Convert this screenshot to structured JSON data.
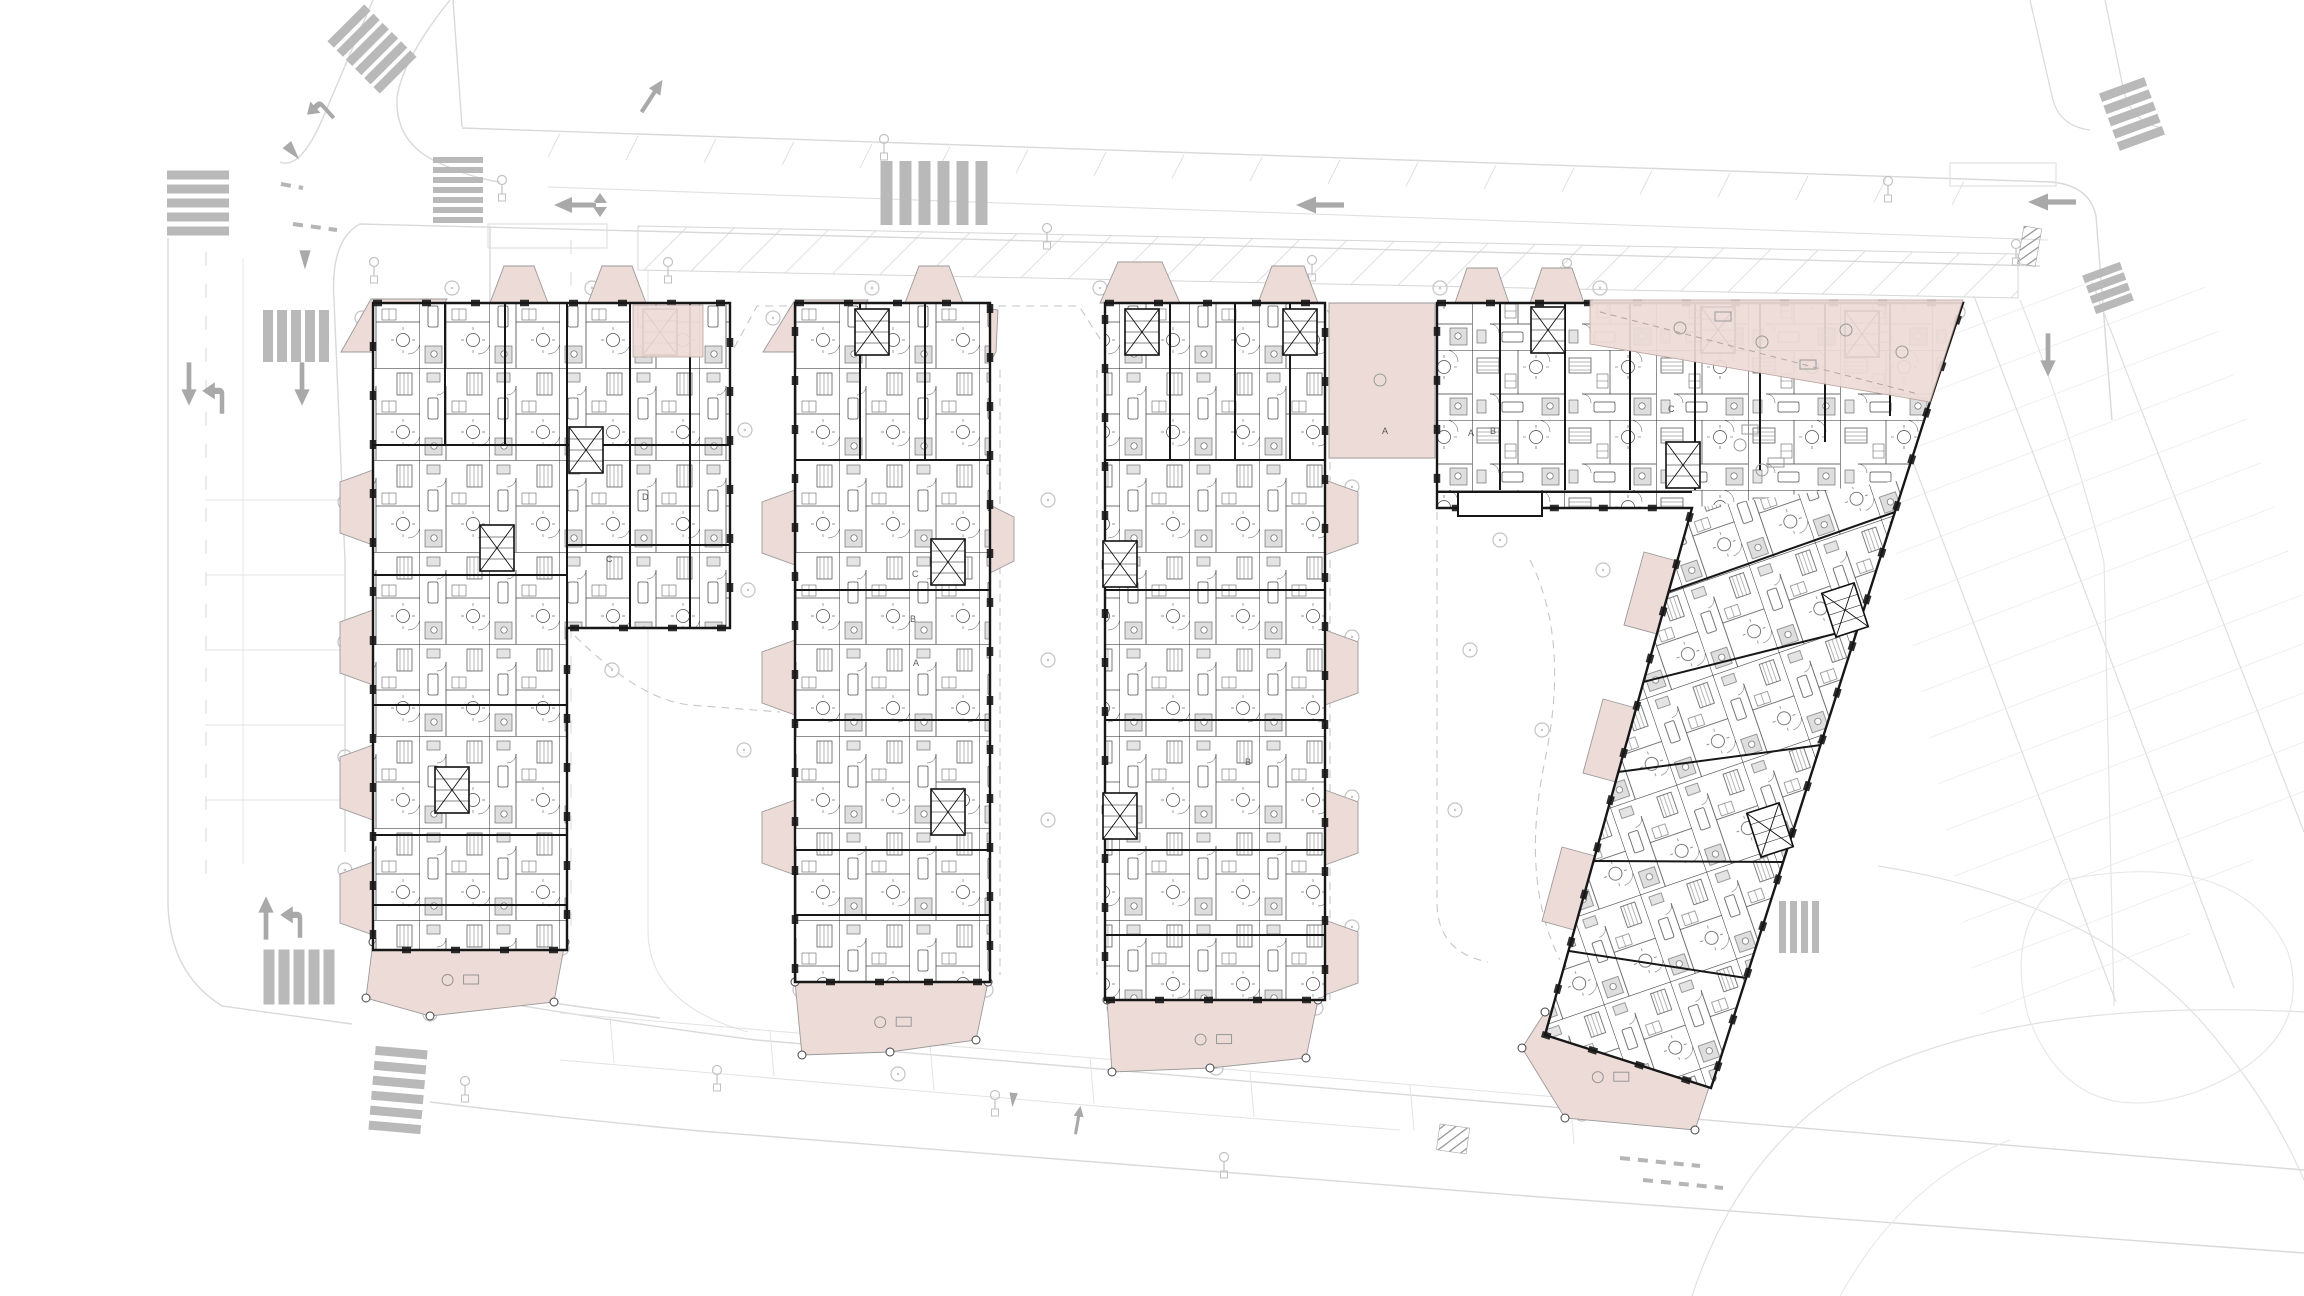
{
  "meta": {
    "drawing_type": "architectural residential site plan / floor plan",
    "floor": "typical floor with ground-level roads",
    "visible_text_labels": [
      "A",
      "B",
      "C",
      "D"
    ]
  },
  "palette": {
    "terrace_pink": "#eddbd7",
    "terrace_edge": "#9a9a9a",
    "wall_black": "#171717",
    "room_line": "#3d3d3d",
    "road_line": "#d9d9d9",
    "road_line_faint": "#e4e4e4",
    "marking_gray": "#a9a9a9",
    "crosswalk_gray": "#b9b9b9",
    "hatch_gray": "#cfcfcf",
    "hatch_dark": "#8f8f8f",
    "dash_gray": "#c6c6c6",
    "tree_gray": "#c4c4c4",
    "bath_gray": "#dcdcdc"
  },
  "site": {
    "paths": [
      {
        "d": "M 462,128 L 2052,182 Q 2090,186 2096,216 L 2112,420"
      },
      {
        "d": "M 453,0 L 462,127"
      },
      {
        "d": "M 373,0 L 322,120 Q 300,170 280,162"
      },
      {
        "d": "M 450,0 Q 402,60 397,98 Q 395,140 433,160 Q 470,178 500,182"
      },
      {
        "d": "M 2040,266 L 360,224 Q 330,240 334,300 L 345,560 L 345,852"
      },
      {
        "d": "M 548,187 L 2048,240",
        "c": "#e0e0e0",
        "w": 1.1
      },
      {
        "d": "M 168,238 L 168,900 Q 168,972 222,1006 L 352,1024"
      },
      {
        "d": "M 243,258 L 243,864",
        "c": "#e7e7e7",
        "w": 1
      },
      {
        "d": "M 206,252 L 206,880",
        "c": "#dedede",
        "w": 1.2,
        "dash": "14 18"
      },
      {
        "d": "M 490,226 L 490,930 Q 490,988 560,1004 L 660,1018"
      },
      {
        "d": "M 648,270 L 648,930 Q 648,1004 748,1032",
        "c": "#e4e4e4",
        "w": 1.1
      },
      {
        "d": "M 571,240 L 571,930",
        "c": "#dedede",
        "w": 1.2,
        "dash": "14 18"
      },
      {
        "d": "M 428,990 Q 600,1020 756,1040 L 1540,1106 Q 1820,1128 2304,1170"
      },
      {
        "d": "M 430,1102 Q 560,1118 700,1131 L 1540,1197 Q 1900,1225 2304,1253"
      },
      {
        "d": "M 560,1013 L 1117,1060 L 1640,1104",
        "c": "#e2e2e2",
        "w": 1
      },
      {
        "d": "M 560,1060 L 1120,1108 L 1400,1130",
        "c": "#e2e2e2",
        "w": 1
      },
      {
        "d": "M 2030,0 L 2052,96 Q 2058,126 2090,130",
        "w": 1.2
      },
      {
        "d": "M 2105,0 L 2124,92 Q 2132,122 2162,128",
        "w": 1.2
      },
      {
        "d": "M 2020,300 Q 2068,420 2104,562 L 2114,1006",
        "c": "#e2e2e2",
        "w": 1.1
      },
      {
        "d": "M 1878,866 Q 2090,900 2200,1020 Q 2270,1100 2304,1180",
        "c": "#e0e0e0",
        "w": 1.2
      },
      {
        "d": "M 1692,1296 Q 1745,1135 1880,1068 Q 2040,998 2304,1012",
        "c": "#e0e0e0",
        "w": 1.2
      },
      {
        "d": "M 2064,880 Q 2240,846 2288,952 Q 2316,1046 2196,1092 Q 2072,1134 2028,1016 Q 2004,922 2064,880 Z",
        "c": "#e6e6e6",
        "w": 1.1
      },
      {
        "d": "M 1840,1296 Q 1905,1180 2010,1140",
        "c": "#e6e6e6",
        "w": 1
      }
    ],
    "rects": [
      [
        488,
        224,
        119,
        24
      ],
      [
        1950,
        163,
        106,
        23
      ]
    ],
    "hatch_strip": "638,226 2018,254 2018,298 638,270",
    "park_field": "1852,308 2200,270 2304,600 2304,800 2130,1005 1985,1046",
    "field_rows": [
      [
        1856,
        310,
        2116,
        1002
      ],
      [
        1974,
        296,
        2234,
        988
      ],
      [
        2092,
        282,
        2304,
        832
      ]
    ],
    "left_stalls": {
      "x1": 205,
      "x2": 345,
      "ys": [
        500,
        575,
        650,
        725,
        800
      ]
    },
    "bottom_stalls": {
      "x": 610,
      "y": 1017,
      "n": 7,
      "dx": 160,
      "dy": 13.5,
      "len": 46
    },
    "top_bays": {
      "x0": 560,
      "x1": 2010,
      "step": 78,
      "y0": 128,
      "slope": 0.034,
      "len": 24
    },
    "crosswalks": [
      {
        "x": 372,
        "y": 49,
        "n": 6,
        "bw": 52,
        "bh": 9,
        "gap": 13,
        "rot": -45,
        "stack": "v"
      },
      {
        "x": 934,
        "y": 193,
        "n": 6,
        "bw": 12,
        "bh": 64,
        "gap": 19,
        "rot": 0
      },
      {
        "x": 458,
        "y": 190,
        "n": 7,
        "bw": 50,
        "bh": 6,
        "gap": 10,
        "stack": "v",
        "rot": 0
      },
      {
        "x": 198,
        "y": 203,
        "n": 5,
        "bw": 62,
        "bh": 9,
        "gap": 14,
        "rot": 0,
        "stack": "v"
      },
      {
        "x": 296,
        "y": 336,
        "n": 5,
        "bw": 10,
        "bh": 52,
        "gap": 14,
        "rot": 0
      },
      {
        "x": 299,
        "y": 977,
        "n": 5,
        "bw": 11,
        "bh": 55,
        "gap": 15,
        "rot": 0
      },
      {
        "x": 398,
        "y": 1090,
        "n": 6,
        "bw": 52,
        "bh": 9,
        "gap": 15,
        "stack": "v",
        "rot": 5
      },
      {
        "x": 1799,
        "y": 927,
        "n": 4,
        "bw": 7,
        "bh": 52,
        "gap": 11,
        "rot": 0
      },
      {
        "x": 2132,
        "y": 114,
        "n": 5,
        "bw": 48,
        "bh": 9,
        "gap": 13,
        "rot": -20,
        "stack": "v"
      },
      {
        "x": 2108,
        "y": 288,
        "n": 4,
        "bw": 40,
        "bh": 8,
        "gap": 11,
        "rot": -20,
        "stack": "v"
      }
    ],
    "dark_patches": [
      [
        2024,
        226,
        18,
        38,
        10
      ],
      [
        1740,
        795,
        40,
        22,
        -25
      ],
      [
        1440,
        1124,
        30,
        26,
        8
      ]
    ],
    "arrows": [
      [
        "double",
        582,
        205,
        0,
        1
      ],
      [
        "left",
        1320,
        205,
        0,
        1
      ],
      [
        "left",
        2052,
        202,
        0,
        1
      ],
      [
        "turnleft",
        322,
        105,
        -42,
        0.8
      ],
      [
        "tri",
        293,
        152,
        -40,
        0.8
      ],
      [
        "tri",
        305,
        260,
        0,
        0.8
      ],
      [
        "down",
        189,
        384,
        0,
        0.9
      ],
      [
        "turnleft",
        222,
        394,
        0,
        0.9
      ],
      [
        "down",
        302,
        384,
        0,
        0.9
      ],
      [
        "up",
        266,
        918,
        0,
        0.9
      ],
      [
        "turnleft",
        300,
        918,
        0,
        0.9
      ],
      [
        "up",
        652,
        96,
        33,
        0.8
      ],
      [
        "down",
        2048,
        355,
        0,
        0.9
      ],
      [
        "up",
        1078,
        1120,
        10,
        0.6
      ],
      [
        "tri",
        1013,
        1100,
        5,
        0.6
      ]
    ],
    "marks": [
      [
        281,
        184,
        303,
        188
      ],
      [
        293,
        224,
        337,
        230
      ],
      [
        1620,
        1158,
        1700,
        1166
      ],
      [
        1643,
        1180,
        1723,
        1188
      ]
    ],
    "lamps": [
      [
        502,
        180
      ],
      [
        374,
        262
      ],
      [
        668,
        262
      ],
      [
        884,
        139
      ],
      [
        1047,
        228
      ],
      [
        1312,
        260
      ],
      [
        1567,
        263
      ],
      [
        2016,
        244
      ],
      [
        1888,
        181
      ],
      [
        1795,
        762
      ],
      [
        1721,
        832
      ],
      [
        717,
        1070
      ],
      [
        995,
        1095
      ],
      [
        1224,
        1157
      ],
      [
        465,
        1081
      ]
    ],
    "courtyard_dashes": [
      "M 734,348 L 757,306 L 792,306",
      "M 976,342 L 999,306 L 1079,306 L 1102,342",
      "M 1000,370 L 1000,975",
      "M 1097,370 L 1097,975",
      "M 575,636 Q 640,700 690,705 L 780,712",
      "M 1437,512 L 1437,902 Q 1437,952 1488,962",
      "M 1330,462 L 1330,1000",
      "M 1327,310 L 1435,455",
      "M 1530,560 Q 1570,640 1545,760 Q 1520,880 1560,960"
    ],
    "trees": [
      [
        362,
        318
      ],
      [
        452,
        288
      ],
      [
        592,
        288
      ],
      [
        700,
        430
      ],
      [
        773,
        318
      ],
      [
        872,
        288
      ],
      [
        1100,
        288
      ],
      [
        1440,
        288
      ],
      [
        1600,
        288
      ],
      [
        1958,
        312
      ],
      [
        345,
        502
      ],
      [
        345,
        642
      ],
      [
        345,
        757
      ],
      [
        345,
        870
      ],
      [
        430,
        1014
      ],
      [
        383,
        948
      ],
      [
        562,
        948
      ],
      [
        745,
        430
      ],
      [
        748,
        590
      ],
      [
        744,
        750
      ],
      [
        800,
        990
      ],
      [
        986,
        990
      ],
      [
        898,
        1074
      ],
      [
        1048,
        500
      ],
      [
        1048,
        660
      ],
      [
        1048,
        820
      ],
      [
        1352,
        487
      ],
      [
        1352,
        637
      ],
      [
        1352,
        797
      ],
      [
        1352,
        927
      ],
      [
        1114,
        1008
      ],
      [
        1316,
        1008
      ],
      [
        1216,
        1068
      ],
      [
        1500,
        540
      ],
      [
        1470,
        650
      ],
      [
        1542,
        730
      ],
      [
        1455,
        810
      ],
      [
        1603,
        570
      ],
      [
        1723,
        500
      ],
      [
        1748,
        514
      ],
      [
        1710,
        527
      ],
      [
        1552,
        1018
      ],
      [
        1702,
        1078
      ],
      [
        1582,
        1114
      ],
      [
        612,
        670
      ]
    ],
    "dark_dot": [
      1773,
      444
    ]
  },
  "buildings": [
    {
      "name": "building-block-a",
      "outline": "M 373,303 L 730,303 L 730,628 L 567,628 L 567,950 L 373,950 Z",
      "shapes": [
        {
          "d": "M 373,303 L 730,303 L 730,628 L 567,628 L 567,950 L 373,950 Z",
          "fill": "aptV"
        }
      ],
      "walls": [
        [
          445,
          303,
          445,
          445
        ],
        [
          505,
          303,
          505,
          445
        ],
        [
          567,
          303,
          567,
          628
        ],
        [
          630,
          303,
          630,
          628
        ],
        [
          690,
          303,
          690,
          628
        ],
        [
          567,
          445,
          730,
          445
        ],
        [
          567,
          545,
          730,
          545
        ],
        [
          373,
          445,
          567,
          445
        ],
        [
          373,
          575,
          567,
          575
        ],
        [
          373,
          705,
          567,
          705
        ],
        [
          373,
          835,
          567,
          835
        ],
        [
          373,
          905,
          567,
          905
        ]
      ],
      "cores": [
        [
          497,
          548
        ],
        [
          452,
          790
        ],
        [
          586,
          450
        ],
        [
          660,
          332
        ]
      ],
      "under": [
        "341,352 371,299 447,299 410,352",
        "490,303 504,266 534,266 548,303",
        "588,303 602,266 632,266 646,303",
        "373,470 340,482 340,533 373,545",
        "373,610 340,622 340,673 373,685",
        "373,745 340,757 340,808 373,820",
        "373,862 340,874 340,923 373,935",
        "373,942 565,942 554,1002 430,1016 366,998"
      ],
      "over": [
        "633,305 703,305 703,357 633,357"
      ]
    },
    {
      "name": "building-block-b1",
      "outline": "M 795,303 L 990,303 L 990,982 L 795,982 Z",
      "shapes": [
        {
          "d": "M 795,303 L 990,303 L 990,982 L 795,982 Z",
          "fill": "aptV"
        }
      ],
      "walls": [
        [
          860,
          303,
          860,
          460
        ],
        [
          925,
          303,
          925,
          460
        ],
        [
          795,
          460,
          990,
          460
        ],
        [
          795,
          590,
          990,
          590
        ],
        [
          795,
          720,
          990,
          720
        ],
        [
          795,
          850,
          990,
          850
        ],
        [
          795,
          915,
          990,
          915
        ]
      ],
      "cores": [
        [
          872,
          332
        ],
        [
          948,
          562
        ],
        [
          948,
          812
        ]
      ],
      "under": [
        "763,352 795,300 868,300 838,352",
        "905,303 919,266 949,266 963,303",
        "972,306 998,310 996,352 972,392",
        "795,490 762,502 762,553 795,565",
        "795,640 762,652 762,703 795,715",
        "795,800 762,812 762,863 795,875",
        "990,505 1014,517 1014,561 990,573",
        "795,982 988,982 976,1040 890,1052 802,1055"
      ],
      "over": []
    },
    {
      "name": "building-block-b2",
      "outline": "M 1105,303 L 1325,303 L 1325,1000 L 1105,1000 Z",
      "shapes": [
        {
          "d": "M 1105,303 L 1325,303 L 1325,1000 L 1105,1000 Z",
          "fill": "aptV"
        }
      ],
      "walls": [
        [
          1170,
          303,
          1170,
          460
        ],
        [
          1235,
          303,
          1235,
          460
        ],
        [
          1290,
          303,
          1290,
          460
        ],
        [
          1105,
          460,
          1325,
          460
        ],
        [
          1105,
          590,
          1325,
          590
        ],
        [
          1105,
          720,
          1325,
          720
        ],
        [
          1105,
          850,
          1325,
          850
        ],
        [
          1105,
          935,
          1325,
          935
        ]
      ],
      "cores": [
        [
          1142,
          332
        ],
        [
          1300,
          332
        ],
        [
          1120,
          564
        ],
        [
          1120,
          816
        ]
      ],
      "under": [
        "1100,303 1118,262 1162,262 1180,303",
        "1258,303 1272,266 1304,266 1318,303",
        "1325,480 1358,492 1358,543 1325,555",
        "1325,630 1358,642 1358,693 1325,705",
        "1325,790 1358,802 1358,853 1325,865",
        "1325,920 1358,932 1358,983 1325,995",
        "1107,1000 1318,1000 1306,1058 1210,1068 1112,1072"
      ],
      "over": []
    },
    {
      "name": "building-block-c",
      "outline": "M 1437,303 L 1963,303 L 1930,402 L 1711,1088 L 1545,1035 L 1692,508 L 1437,508 Z",
      "shapes": [
        {
          "d": "M 1437,303 L 1963,303 L 1930,402 L 1905,480 L 1692,508 L 1437,508 Z",
          "fill": "aptH"
        },
        {
          "d": "M 1692,508 L 1905,480 L 1711,1088 L 1545,1035 Z",
          "fill": "aptD"
        }
      ],
      "walls": [
        [
          1500,
          303,
          1500,
          490
        ],
        [
          1565,
          303,
          1565,
          490
        ],
        [
          1630,
          303,
          1630,
          490
        ],
        [
          1695,
          303,
          1695,
          490
        ],
        [
          1760,
          303,
          1760,
          470
        ],
        [
          1825,
          303,
          1825,
          442
        ],
        [
          1890,
          303,
          1890,
          416
        ],
        [
          1437,
          492,
          1692,
          492
        ],
        [
          1668,
          592,
          1895,
          512
        ],
        [
          1643,
          682,
          1858,
          628
        ],
        [
          1618,
          772,
          1821,
          745
        ],
        [
          1594,
          861,
          1783,
          862
        ],
        [
          1569,
          951,
          1746,
          978
        ]
      ],
      "cores": [
        [
          1548,
          330
        ],
        [
          1718,
          330
        ],
        [
          1862,
          334
        ],
        [
          1683,
          465
        ],
        [
          1845,
          610,
          -18
        ],
        [
          1770,
          830,
          -18
        ]
      ],
      "bump": [
        1458,
        492,
        84,
        24
      ],
      "under": [
        "1455,303 1467,268 1497,268 1509,303",
        "1530,303 1542,268 1572,268 1584,303",
        "1329,303 1435,303 1435,458 1329,458",
        "1677,561 1644,552 1624,625 1657,634",
        "1636,708 1603,699 1583,773 1616,782",
        "1595,856 1562,847 1542,921 1574,930",
        "1545,1012 1712,1078 1695,1130 1565,1118 1522,1048"
      ],
      "over": [
        "1590,300 1963,300 1930,402 1590,344"
      ],
      "decor": {
        "circles": [
          [
            1680,
            328
          ],
          [
            1762,
            342
          ],
          [
            1846,
            330
          ],
          [
            1902,
            352
          ],
          [
            1380,
            380
          ],
          [
            1740,
            445
          ],
          [
            1762,
            470
          ]
        ],
        "rects": [
          [
            1715,
            312
          ],
          [
            1800,
            360
          ],
          [
            1742,
            425
          ],
          [
            1768,
            458
          ]
        ],
        "dash": "M 1600,312 L 1918,394"
      }
    }
  ],
  "unit_labels": [
    [
      "C",
      912,
      577
    ],
    [
      "B",
      910,
      622
    ],
    [
      "A",
      913,
      666
    ],
    [
      "A",
      1468,
      436
    ],
    [
      "B",
      1490,
      434
    ],
    [
      "C",
      1668,
      412
    ],
    [
      "D",
      642,
      500
    ],
    [
      "C",
      606,
      562
    ],
    [
      "A",
      1382,
      434
    ],
    [
      "B",
      1245,
      765
    ]
  ]
}
